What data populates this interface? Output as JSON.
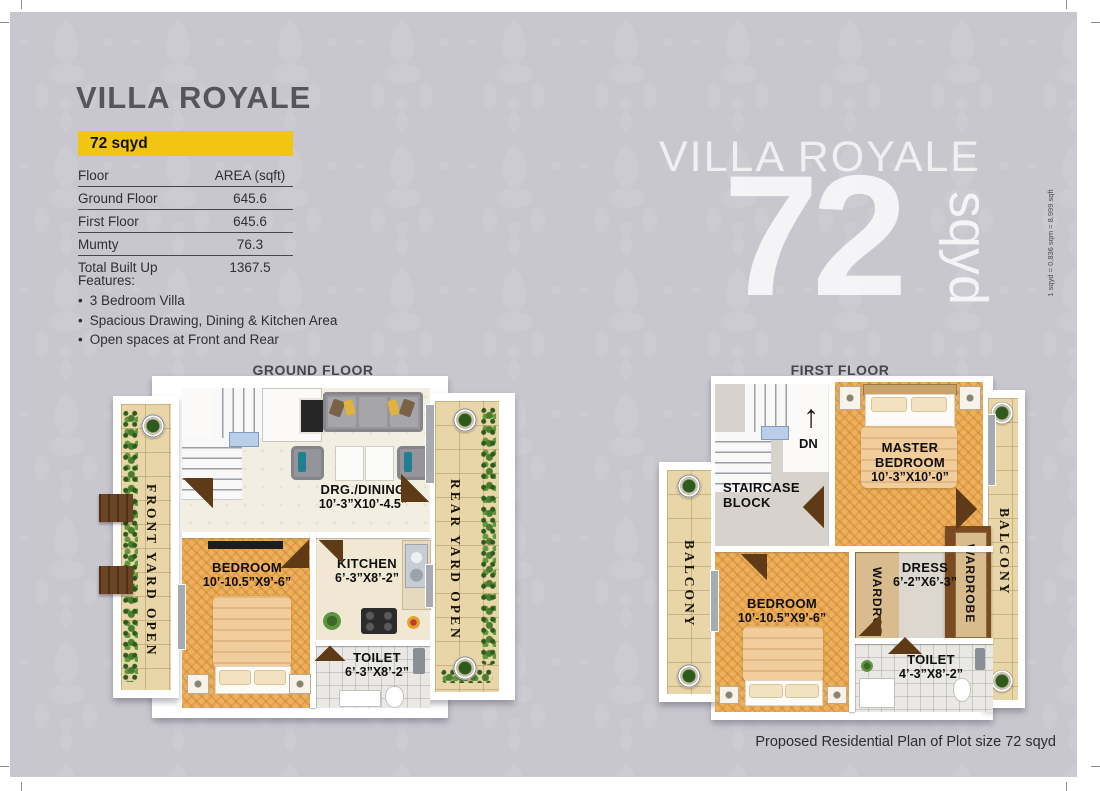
{
  "page": {
    "caption": "Proposed Residential Plan of Plot size 72 sqyd",
    "conversion_note": "1 sqyd = 0.836 sqm = 8.999 sqft"
  },
  "info_panel": {
    "title": "VILLA ROYALE",
    "plot_badge": "72 sqyd",
    "area_table": {
      "col_floor": "Floor",
      "col_area": "AREA (sqft)",
      "rows": [
        {
          "label": "Ground Floor",
          "value": "645.6"
        },
        {
          "label": "First Floor",
          "value": "645.6"
        },
        {
          "label": "Mumty",
          "value": "76.3"
        },
        {
          "label": "Total Built Up",
          "value": "1367.5"
        }
      ]
    },
    "features": {
      "heading": "Features:",
      "bullet": "•",
      "items": [
        "3 Bedroom Villa",
        "Spacious Drawing, Dining & Kitchen Area",
        "Open spaces at Front and Rear"
      ]
    }
  },
  "watermark": {
    "title": "VILLA ROYALE",
    "number": "72",
    "unit": "sqyd"
  },
  "ground_floor": {
    "heading": "GROUND FLOOR",
    "front_yard_label": "FRONT YARD OPEN",
    "rear_yard_label": "REAR YARD OPEN",
    "drg_dining": {
      "name": "DRG./DINING",
      "dim": "10’-3”X10’-4.5”"
    },
    "bedroom": {
      "name": "BEDROOM",
      "dim": "10’-10.5”X9’-6”"
    },
    "kitchen": {
      "name": "KITCHEN",
      "dim": "6’-3”X8’-2”"
    },
    "toilet": {
      "name": "TOILET",
      "dim": "6’-3”X8’-2”"
    }
  },
  "first_floor": {
    "heading": "FIRST FLOOR",
    "balcony_left_label": "BALCONY",
    "balcony_right_label": "BALCONY",
    "staircase_line1": "STAIRCASE",
    "staircase_line2": "BLOCK",
    "down_label": "DN",
    "down_arrow": "↑",
    "master_bedroom": {
      "line1": "MASTER",
      "line2": "BEDROOM",
      "dim": "10’-3”X10’-0”"
    },
    "bedroom": {
      "name": "BEDROOM",
      "dim": "10’-10.5”X9’-6”"
    },
    "wardrobe_left_label": "WARDROBE",
    "wardrobe_right_label": "WARDROBE",
    "dress": {
      "name": "DRESS",
      "dim": "6’-2”X6’-3”"
    },
    "toilet": {
      "name": "TOILET",
      "dim": "4’-3”X8’-2”"
    }
  },
  "colors": {
    "badge_yellow": "#f2c513",
    "background_gray": "#c8c7ce",
    "floor_orange": "#edb05c",
    "yard_beige": "#e9d6a8",
    "hedge_green": "#47752e",
    "wardrobe_brown": "#7c4a21",
    "title_gray": "#55555b"
  }
}
